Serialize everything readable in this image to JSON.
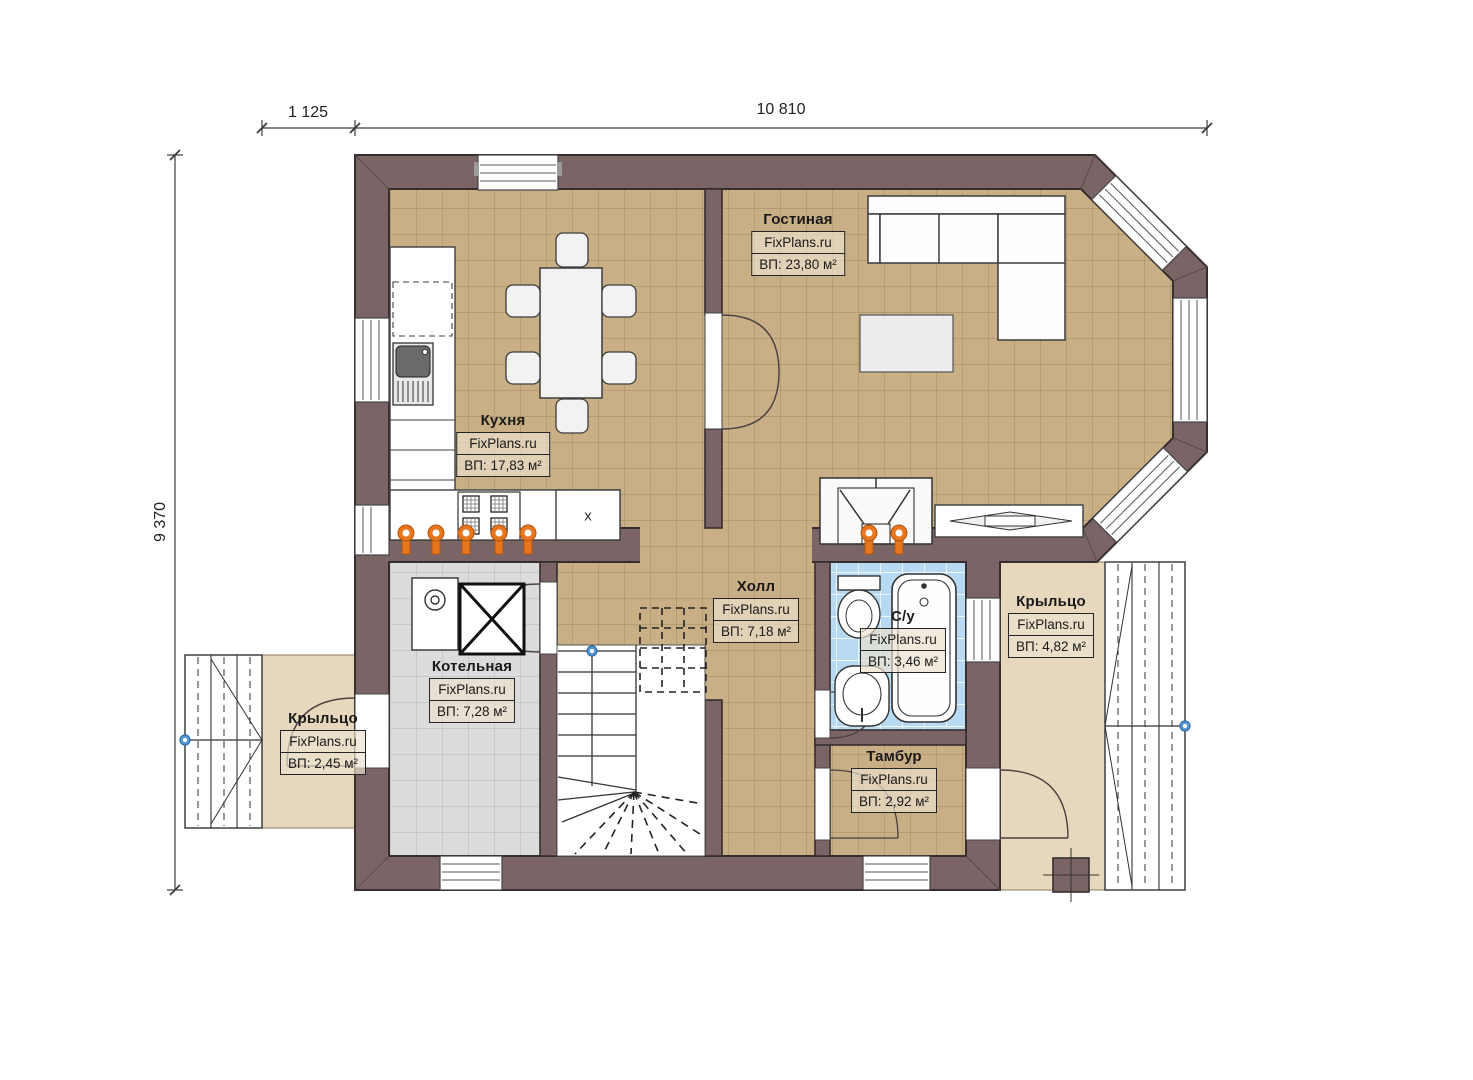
{
  "plan": {
    "title": "First floor plan",
    "dimensions": {
      "top_left": "1 125",
      "top_main": "10 810",
      "left": "9 370"
    },
    "rooms": [
      {
        "name": "Гостиная",
        "brand": "FixPlans.ru",
        "area": "ВП: 23,80 м²"
      },
      {
        "name": "Кухня",
        "brand": "FixPlans.ru",
        "area": "ВП: 17,83 м²"
      },
      {
        "name": "Холл",
        "brand": "FixPlans.ru",
        "area": "ВП: 7,18 м²"
      },
      {
        "name": "С/у",
        "brand": "FixPlans.ru",
        "area": "ВП: 3,46 м²"
      },
      {
        "name": "Крыльцо",
        "brand": "FixPlans.ru",
        "area": "ВП: 4,82 м²"
      },
      {
        "name": "Котельная",
        "brand": "FixPlans.ru",
        "area": "ВП: 7,28 м²"
      },
      {
        "name": "Крыльцо",
        "brand": "FixPlans.ru",
        "area": "ВП: 2,45 м²"
      },
      {
        "name": "Тамбур",
        "brand": "FixPlans.ru",
        "area": "ВП: 2,92 м²"
      }
    ],
    "annotations": {
      "cabinet_mark": "x"
    },
    "colors": {
      "wall": "#7b6466",
      "wall_outline": "#362d2f",
      "floor_tile": "#c9af85",
      "floor_grout": "#a98f66",
      "boiler_room_tile": "#dcdcdc",
      "bathroom_tile": "#b7d9f2",
      "porch": "#e7d8bd",
      "radiator_orange": "#e8761e",
      "marker_blue": "#5a9bd5"
    }
  }
}
